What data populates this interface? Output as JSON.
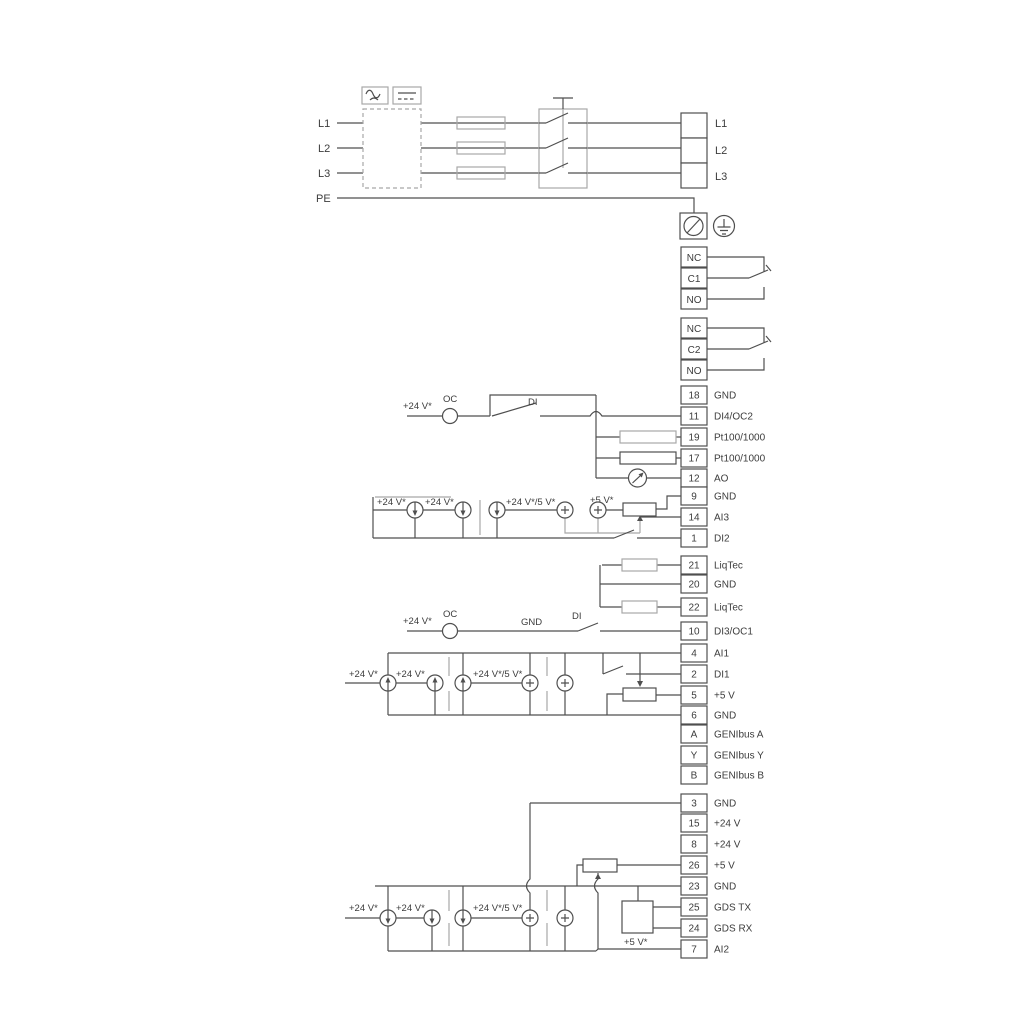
{
  "power": {
    "inputs": [
      "L1",
      "L2",
      "L3",
      "PE"
    ],
    "outputs": [
      "L1",
      "L2",
      "L3"
    ]
  },
  "relays": [
    {
      "cells": [
        "NC",
        "C1",
        "NO"
      ]
    },
    {
      "cells": [
        "NC",
        "C2",
        "NO"
      ]
    }
  ],
  "terminals": [
    {
      "num": "18",
      "label": "GND"
    },
    {
      "num": "11",
      "label": "DI4/OC2"
    },
    {
      "num": "19",
      "label": "Pt100/1000"
    },
    {
      "num": "17",
      "label": "Pt100/1000"
    },
    {
      "num": "12",
      "label": "AO"
    },
    {
      "num": "9",
      "label": "GND"
    },
    {
      "num": "14",
      "label": "AI3"
    },
    {
      "num": "1",
      "label": "DI2"
    },
    {
      "num": "21",
      "label": "LiqTec"
    },
    {
      "num": "20",
      "label": "GND"
    },
    {
      "num": "22",
      "label": "LiqTec"
    },
    {
      "num": "10",
      "label": "DI3/OC1"
    },
    {
      "num": "4",
      "label": "AI1"
    },
    {
      "num": "2",
      "label": "DI1"
    },
    {
      "num": "5",
      "label": "+5 V"
    },
    {
      "num": "6",
      "label": "GND"
    },
    {
      "num": "A",
      "label": "GENIbus A"
    },
    {
      "num": "Y",
      "label": "GENIbus Y"
    },
    {
      "num": "B",
      "label": "GENIbus B"
    },
    {
      "num": "3",
      "label": "GND"
    },
    {
      "num": "15",
      "label": "+24 V"
    },
    {
      "num": "8",
      "label": "+24 V"
    },
    {
      "num": "26",
      "label": "+5 V"
    },
    {
      "num": "23",
      "label": "GND"
    },
    {
      "num": "25",
      "label": "GDS TX"
    },
    {
      "num": "24",
      "label": "GDS RX"
    },
    {
      "num": "7",
      "label": "AI2"
    }
  ],
  "sections": {
    "di4": {
      "v24": "+24 V*",
      "oc": "OC",
      "di": "DI"
    },
    "ai3": {
      "v24_1": "+24 V*",
      "v24_2": "+24 V*",
      "v24_5": "+24 V*/5 V*",
      "v5": "+5 V*"
    },
    "di3": {
      "v24": "+24 V*",
      "oc": "OC",
      "gnd": "GND",
      "di": "DI"
    },
    "ai1": {
      "v24_1": "+24 V*",
      "v24_2": "+24 V*",
      "v24_5": "+24 V*/5 V*"
    },
    "ai2": {
      "v24_1": "+24 V*",
      "v24_2": "+24 V*",
      "v24_5": "+24 V*/5 V*",
      "v5": "+5 V*"
    }
  },
  "colors": {
    "line": "#4f4f4f",
    "line_gray": "#a8a8a8",
    "background": "#ffffff"
  }
}
